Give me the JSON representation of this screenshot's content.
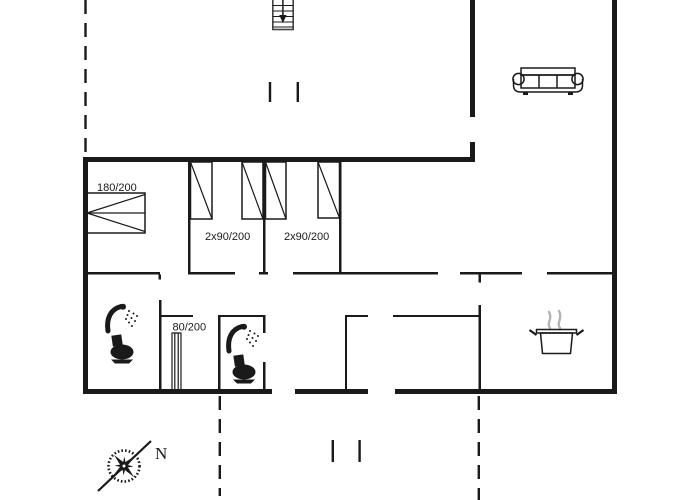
{
  "labels": {
    "bed_double": "180/200",
    "bed_twin_left": "2x90/200",
    "bed_twin_right": "2x90/200",
    "bed_single": "80/200",
    "compass_north": "N"
  },
  "icons": {
    "stairs-icon": "staircase treads with down arrow",
    "sofa-icon": "three-seat sofa top view",
    "shower-icon": "shower head with spray dots",
    "toilet-icon": "toilet silhouette",
    "cooking-pot-icon": "pot with steam (kitchen)",
    "compass-rose-icon": "eight-point compass rose with needle"
  },
  "colors": {
    "line": "#1a1a1a",
    "steam": "#b4b4b4",
    "stair_edge": "#444444",
    "background": "#ffffff"
  }
}
